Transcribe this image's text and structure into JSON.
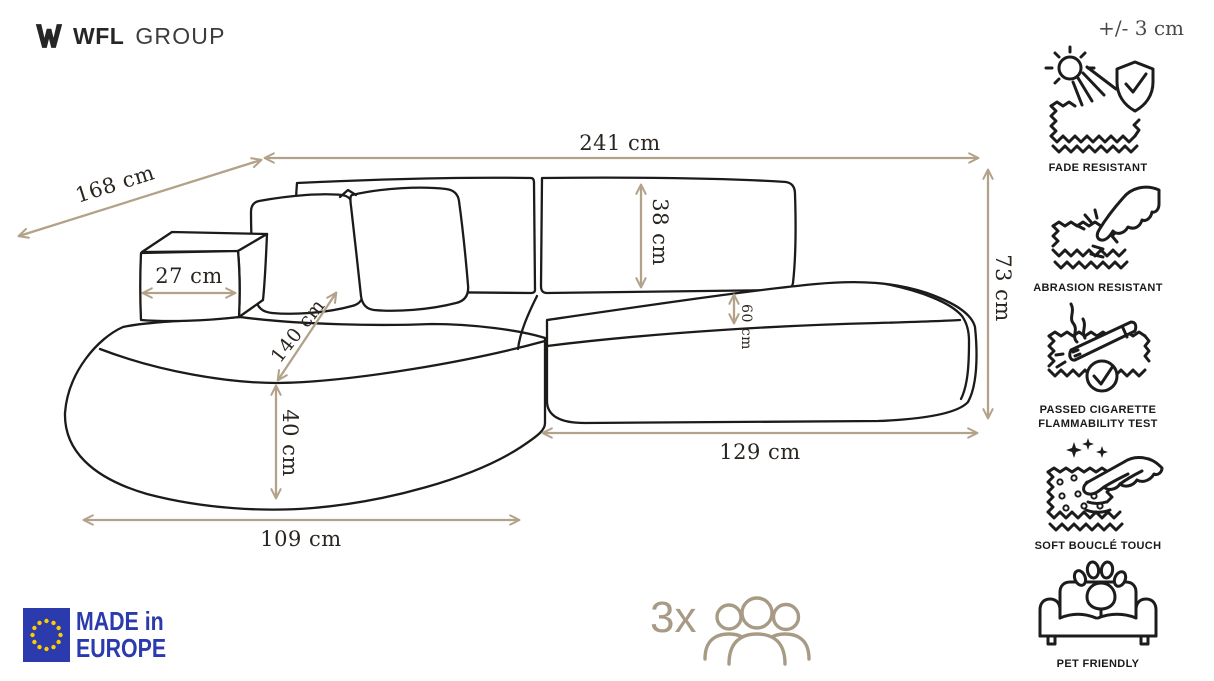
{
  "header": {
    "logo": {
      "bold": "WFL",
      "light": "GROUP"
    },
    "tolerance": "+/- 3 cm"
  },
  "dimensions": {
    "width_total": "241 cm",
    "depth_left_diagonal": "168 cm",
    "arm_width": "27 cm",
    "chaise_length": "140 cm",
    "backrest_height": "38 cm",
    "seat_gap": "60 cm",
    "height_total": "73 cm",
    "seat_length_right": "129 cm",
    "front_height": "40 cm",
    "chaise_width": "109 cm"
  },
  "features": [
    {
      "icon": "sun-shield-icon",
      "label": "FADE RESISTANT"
    },
    {
      "icon": "abrasion-hand-icon",
      "label": "ABRASION RESISTANT"
    },
    {
      "icon": "cigarette-test-icon",
      "label_line1": "PASSED CIGARETTE",
      "label_line2": "FLAMMABILITY TEST"
    },
    {
      "icon": "soft-touch-icon",
      "label": "SOFT BOUCLÉ TOUCH"
    },
    {
      "icon": "pet-sofa-icon",
      "label": "PET FRIENDLY"
    }
  ],
  "footer": {
    "made_in": {
      "line1": "MADE in",
      "line2": "EUROPE"
    },
    "capacity": {
      "count": "3x"
    }
  },
  "colors": {
    "dimension_line": "#b3a28a",
    "dimension_text": "#2b2520",
    "sofa_outline": "#1d1b19",
    "eu_blue": "#2b3aad",
    "star_yellow": "#ffcc00",
    "people_tan": "#a79b86"
  }
}
